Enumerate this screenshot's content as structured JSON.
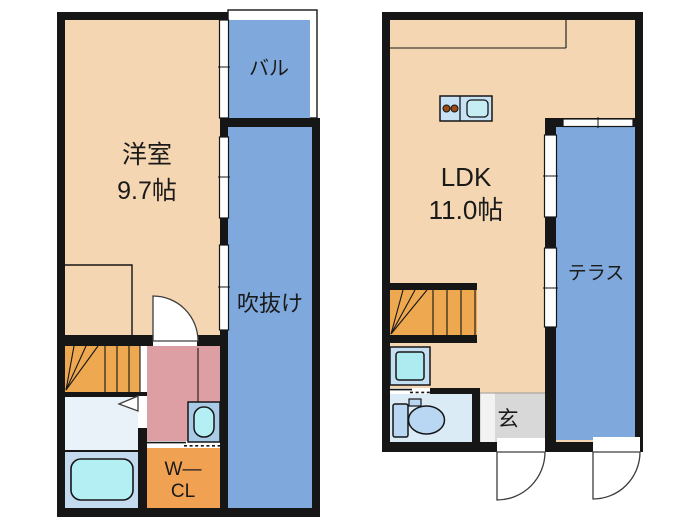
{
  "colors": {
    "wall": "#161616",
    "room": "#F5D6B2",
    "blue": "#7FA9DC",
    "stairs": "#EDA850",
    "closet": "#F0A152",
    "hall": "#DD9FA4",
    "washroom": "#EAF2F9",
    "bathroom": "#C4DAEF",
    "tub": "#B4EFF4",
    "basin_box": "#A9CBE6",
    "basin_oval": "#B4EFF4",
    "basin_right_box": "#C5DFF2",
    "basin_right_inner": "#AEEBF0",
    "counter": "#C7E1F5",
    "sink": "#C6EDF4",
    "burner": "#9C4B15",
    "toilet_room": "#DAEBF6",
    "toilet_fixture": "#B9D6F2",
    "genkan": "#D8D8D8",
    "genkan_step": "#F2F2F2",
    "text": "#1A1A1A"
  },
  "floor2": {
    "room_label": "洋室",
    "room_size": "9.7帖",
    "balcony_label": "バル",
    "void_label": "吹抜け",
    "closet_line1": "W—",
    "closet_line2": "CL"
  },
  "floor1": {
    "ldk_label": "LDK",
    "ldk_size": "11.0帖",
    "terrace_label": "テラス",
    "entrance_label": "玄"
  }
}
